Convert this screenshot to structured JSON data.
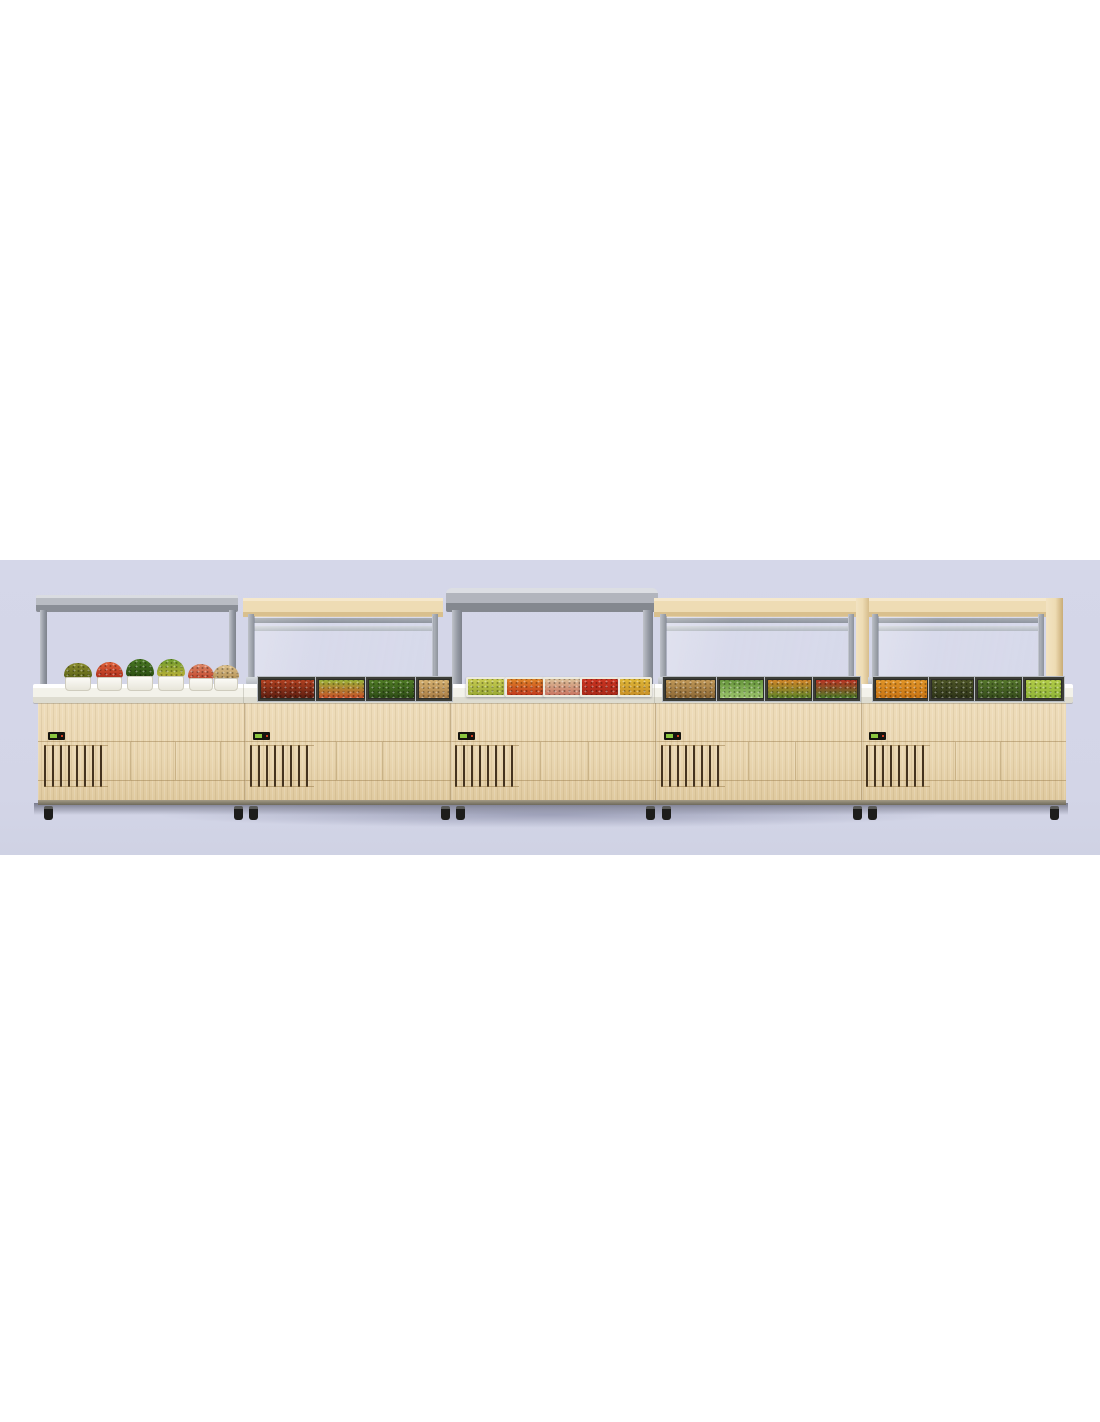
{
  "meta": {
    "description": "3D product render of a five-module buffet salad-bar line: light-wood refrigerated base cabinets with ventilation grilles, digital control panels and casters, a white serving counter, two open-top modules with flat stainless canopies (one with salad bowls, one with flat trays), and three wood-framed glass display modules holding chilled food pans, shown against a pale lavender backdrop."
  },
  "palette": {
    "backdrop": "#d5d7e9",
    "page-white": "#ffffff",
    "wood-base": "#e9d6b0",
    "wood-beam": "#eedcb4",
    "metal-light": "#c6c9d0",
    "metal-mid": "#a2a6ae",
    "metal-dark": "#84888f",
    "counter-white": "#f7f6f1",
    "vent-slat": "#44331f",
    "panel-black": "#15140e",
    "panel-green": "#8bc63f",
    "caster-black": "#1d1d1b",
    "shadow": "#6c708e"
  },
  "unit": {
    "modules": [
      {
        "id": "module-1",
        "type": "open-top-canopy",
        "contents": "six square salad bowls on counter"
      },
      {
        "id": "module-2",
        "type": "glass-display",
        "contents": "four chilled food pans"
      },
      {
        "id": "module-3",
        "type": "open-top-canopy",
        "contents": "five flat food trays on counter"
      },
      {
        "id": "module-4",
        "type": "glass-display",
        "contents": "four chilled food pans"
      },
      {
        "id": "module-5",
        "type": "glass-display",
        "contents": "four chilled food pans"
      }
    ],
    "base": {
      "control_panels": 5,
      "vent_grilles": 5,
      "casters": 10
    }
  },
  "foods": [
    {
      "name": "olive-salad-bowl",
      "module": 1,
      "kind": "bowl",
      "left": 63,
      "top": 663,
      "width": 30,
      "height": 28,
      "colors": [
        "#8a8c2e",
        "#565e14"
      ]
    },
    {
      "name": "tomato-seafood-bowl",
      "module": 1,
      "kind": "bowl",
      "left": 95,
      "top": 662,
      "width": 29,
      "height": 29,
      "colors": [
        "#e0623a",
        "#a82818"
      ]
    },
    {
      "name": "broccoli-bowl",
      "module": 1,
      "kind": "bowl",
      "left": 125,
      "top": 659,
      "width": 30,
      "height": 32,
      "colors": [
        "#4a7a24",
        "#27470f"
      ]
    },
    {
      "name": "mixed-greens-bowl",
      "module": 1,
      "kind": "bowl",
      "left": 156,
      "top": 659,
      "width": 30,
      "height": 32,
      "colors": [
        "#6e9c2e",
        "#c2b238"
      ]
    },
    {
      "name": "salmon-bowl",
      "module": 1,
      "kind": "bowl",
      "left": 187,
      "top": 664,
      "width": 28,
      "height": 27,
      "colors": [
        "#de8866",
        "#bc3c24"
      ]
    },
    {
      "name": "pasta-bowl",
      "module": 1,
      "kind": "bowl",
      "left": 212,
      "top": 665,
      "width": 28,
      "height": 26,
      "colors": [
        "#dcc08c",
        "#b08c50"
      ]
    },
    {
      "name": "tomato-pepper-pan",
      "module": 2,
      "kind": "pan",
      "left": 258,
      "top": 677,
      "width": 55,
      "height": 20,
      "colors": [
        "#b04020",
        "#5c1e10"
      ]
    },
    {
      "name": "garden-mix-pan",
      "module": 2,
      "kind": "pan",
      "left": 316,
      "top": 677,
      "width": 47,
      "height": 20,
      "colors": [
        "#9ab238",
        "#c85028"
      ]
    },
    {
      "name": "green-herb-pan",
      "module": 2,
      "kind": "pan",
      "left": 366,
      "top": 677,
      "width": 47,
      "height": 20,
      "colors": [
        "#4e7a24",
        "#2e4c16"
      ]
    },
    {
      "name": "noodle-pan",
      "module": 2,
      "kind": "pan",
      "left": 416,
      "top": 677,
      "width": 32,
      "height": 20,
      "colors": [
        "#d4b070",
        "#a87c44"
      ]
    },
    {
      "name": "lettuce-mix-tray",
      "module": 3,
      "kind": "tray",
      "left": 466,
      "top": 677,
      "width": 36,
      "height": 16,
      "colors": [
        "#c8cc52",
        "#98a834"
      ]
    },
    {
      "name": "roast-veg-tray",
      "module": 3,
      "kind": "tray",
      "left": 505,
      "top": 677,
      "width": 36,
      "height": 16,
      "colors": [
        "#e08428",
        "#c03a1e"
      ]
    },
    {
      "name": "pasta-ham-tray",
      "module": 3,
      "kind": "tray",
      "left": 543,
      "top": 677,
      "width": 35,
      "height": 16,
      "colors": [
        "#dcc09a",
        "#c87460"
      ]
    },
    {
      "name": "tomato-slice-tray",
      "module": 3,
      "kind": "tray",
      "left": 580,
      "top": 677,
      "width": 36,
      "height": 16,
      "colors": [
        "#cc3522",
        "#a82818"
      ]
    },
    {
      "name": "yellow-noodle-tray",
      "module": 3,
      "kind": "tray",
      "left": 618,
      "top": 677,
      "width": 30,
      "height": 16,
      "colors": [
        "#e0b838",
        "#c89028"
      ]
    },
    {
      "name": "grain-salad-pan",
      "module": 4,
      "kind": "pan",
      "left": 663,
      "top": 677,
      "width": 51,
      "height": 20,
      "colors": [
        "#c09858",
        "#8a6634"
      ]
    },
    {
      "name": "green-white-pan",
      "module": 4,
      "kind": "pan",
      "left": 717,
      "top": 677,
      "width": 45,
      "height": 20,
      "colors": [
        "#66953c",
        "#9cc46c"
      ]
    },
    {
      "name": "carrot-herb-pan",
      "module": 4,
      "kind": "pan",
      "left": 765,
      "top": 677,
      "width": 45,
      "height": 20,
      "colors": [
        "#d08428",
        "#5e8428"
      ]
    },
    {
      "name": "pepper-mix-pan",
      "module": 4,
      "kind": "pan",
      "left": 813,
      "top": 677,
      "width": 43,
      "height": 20,
      "colors": [
        "#b83424",
        "#4e7c28"
      ]
    },
    {
      "name": "carrot-shred-pan",
      "module": 5,
      "kind": "pan",
      "left": 873,
      "top": 677,
      "width": 53,
      "height": 20,
      "colors": [
        "#e09428",
        "#c87414"
      ]
    },
    {
      "name": "dark-greens-pan",
      "module": 5,
      "kind": "pan",
      "left": 929,
      "top": 677,
      "width": 43,
      "height": 20,
      "colors": [
        "#4c5426",
        "#2e3418"
      ]
    },
    {
      "name": "spinach-pan",
      "module": 5,
      "kind": "pan",
      "left": 975,
      "top": 677,
      "width": 45,
      "height": 20,
      "colors": [
        "#55762c",
        "#364c1c"
      ]
    },
    {
      "name": "shredded-lettuce-pan",
      "module": 5,
      "kind": "pan",
      "left": 1023,
      "top": 677,
      "width": 37,
      "height": 20,
      "colors": [
        "#b2cc48",
        "#8fb438"
      ]
    }
  ]
}
